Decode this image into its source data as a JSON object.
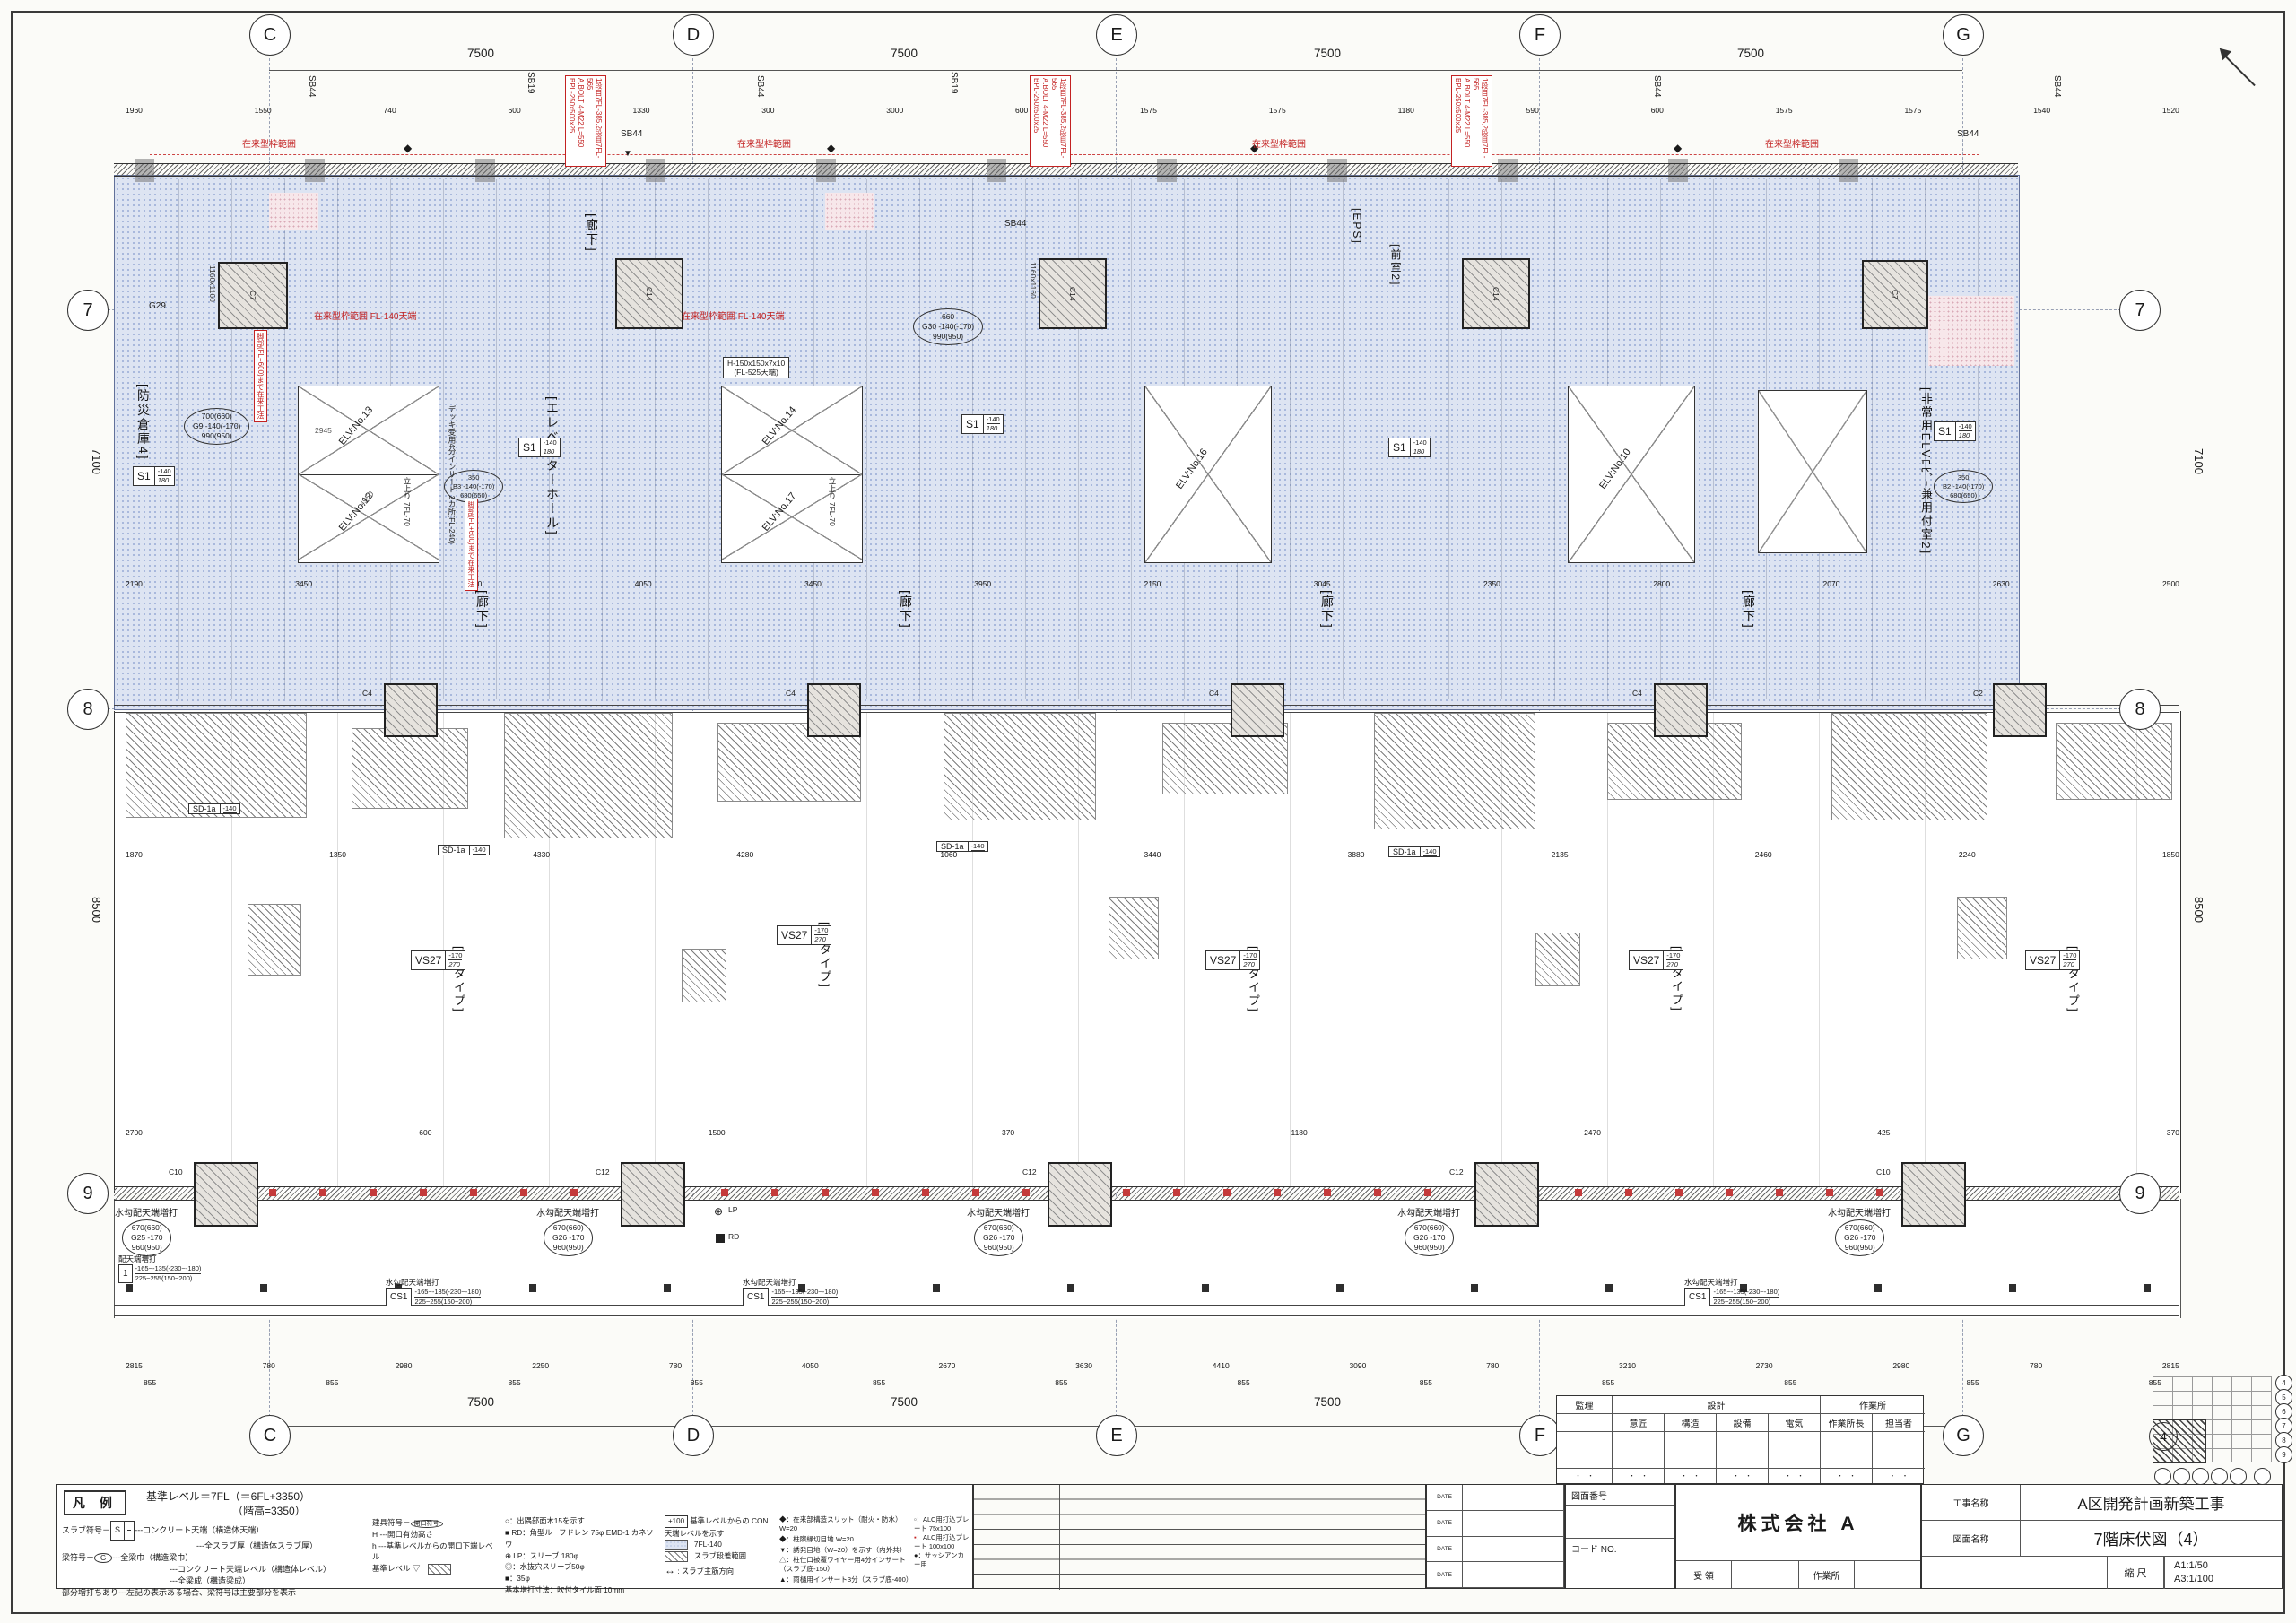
{
  "sheet": {
    "project_label": "工事名称",
    "project_name": "A区開発計画新築工事",
    "drawing_label": "図面名称",
    "drawing_name": "7階床伏図（4）",
    "scale_label": "縮 尺",
    "scale_a1": "A1:1/50",
    "scale_a3": "A3:1/100",
    "company": "株式会社 A",
    "receive_label": "受 領",
    "site_label": "作業所",
    "drawing_no_label": "図面番号",
    "code_no_label": "コード NO.",
    "date_label": "DATE"
  },
  "approval_table": {
    "kanri": "監理",
    "sekkei": "設計",
    "sagyosho": "作業所",
    "sub": [
      "意匠",
      "構造",
      "設備",
      "電気",
      "作業所長",
      "担当者"
    ],
    "dots": "・　・"
  },
  "keyplan": {
    "rows": [
      "4",
      "5",
      "6",
      "7",
      "8",
      "9"
    ],
    "number": "4"
  },
  "legend": {
    "title": "凡 例",
    "base_level": "基準レベル＝7FL（＝6FL+3350）",
    "base_level2": "（階高=3350）",
    "slab_label": "スラブ符号",
    "slab_sym": "S",
    "slab_desc1": "---コンクリート天端（構造体天端）",
    "slab_desc2": "---全スラブ厚（構造体スラブ厚）",
    "beam_label": "梁符号",
    "beam_sym": "G",
    "beam_desc1": "---全梁巾（構造梁巾）",
    "beam_desc2": "---コンクリート天端レベル（構造体レベル）",
    "beam_desc3": "---全梁成（構造梁成）",
    "beam_note": "部分増打ちあり---左記の表示ある場合、梁符号は主要部分を表示",
    "tategu_label": "建具符号",
    "tategu_sym": "開口符号",
    "tategu_h": "H",
    "tategu_h2": "h",
    "tategu_desc1": "開口有効高さ",
    "tategu_desc2": "基準レベルからの開口下端レベル",
    "base_mark": "基準レベル",
    "base_mark_sym": "▽",
    "items_mid": [
      "○：出隅部面木15を示す",
      "■ RD：角型ルーフドレン 75φ EMD-1 カネソウ",
      "⊕ LP：スリーブ 180φ",
      "◎：水抜穴スリーブ50φ",
      "■：35φ",
      "基本増打寸法：吹付タイル面 10mm"
    ],
    "lvl_plus": "+100",
    "lvl_plus_desc": "基準レベルからの CON天端レベルを示す",
    "lvl_dots": "7FL-140",
    "lvl_hatch": "スラブ段差範囲",
    "lvl_arrow": "スラブ主筋方向",
    "arrow_sym": "↔",
    "items_joints": [
      "◆：在来部構造スリット（耐火・防水） W=20",
      "◆：柱際縁切目地 W=20",
      "▼：誘発目地（W=20）を示す（内外共）",
      "△：柱仕口被覆ワイヤー用4分インサート（スラブ底-150）",
      "▲：雨樋用インサート3分（スラブ底-400）"
    ],
    "alc1": "▫：ALC用打込プレート 75x100",
    "alc2_sym": "▪",
    "alc2_text": "：ALC用打込プレート 100x100",
    "alc3": "●：サッシアンカー用"
  },
  "grid": {
    "cols": [
      "C",
      "D",
      "E",
      "F",
      "G"
    ],
    "rows": [
      "7",
      "8",
      "9"
    ],
    "bay": "7500",
    "v_78": "7100",
    "v_89": "8500"
  },
  "plan": {
    "rooms": {
      "bosai": "[防災倉庫4]",
      "elvhall": "[エレベーターホール]",
      "rouka": "[廊下]",
      "zenshitsu": "[前室2]",
      "eps": "[EPS]",
      "hijo": "[非常用ELVﾛﾋﾞｰ兼用付室2]"
    },
    "types": [
      "[14タイプ]",
      "[13タイプ]",
      "[12タイプ]",
      "[11タイプ]",
      "[10タイプ]"
    ],
    "elv": [
      "ELV:No.13",
      "ELV:No.12",
      "ELV:No.14",
      "ELV:No.17",
      "ELV:No.16",
      "ELV:No.10"
    ],
    "red": {
      "zairai": "在来型枠範囲",
      "zairai_fl": "在来型枠範囲 FL-140天端",
      "bpl1": "BPL-250x500x25",
      "bpl2": "A.BOLT 4-M22 L=550",
      "bpl3": "1段目7FL-385,2段目7FL-565",
      "kyakubu": "脚部(FL+600)まで在来工法",
      "deck": "デッキ受用4分インサート 2カ所(FL-240)"
    },
    "tags": {
      "s1": "S1",
      "s1_top": "-140",
      "s1_thk": "180",
      "sd1a": "SD-1a",
      "sd1a_top": "-140",
      "vs27": "VS27",
      "vs27_top": "-170",
      "vs27_thk": "270",
      "cs1": "CS1",
      "cs1_top": "-165~-135(-230~-180)",
      "cs1_thk": "225~255(150~200)",
      "one": "1",
      "c7": "C7",
      "c14": "C14",
      "c4": "C4",
      "c2": "C2",
      "c10": "C10",
      "c12": "C12",
      "col_size": "1160x1160",
      "g29": "G29",
      "g9": [
        "700(660)",
        "G9 -140(-170)",
        "990(950)"
      ],
      "g30": [
        "660",
        "G30 -140(-170)",
        "990(950)"
      ],
      "g25": [
        "670(660)",
        "G25  -170",
        "960(950)"
      ],
      "g26": [
        "670(660)",
        "G26  -170",
        "960(950)"
      ],
      "b3": [
        "350",
        "B3 -140(-170)",
        "680(650)"
      ],
      "b2": [
        "350",
        "B2 -140(-170)",
        "680(650)"
      ]
    },
    "notes": {
      "sb44": "SB44",
      "sb19": "SB19",
      "h_col1": "H-150x150x7x10",
      "h_col2": "(FL-525天端)",
      "tachiagari": "立上り 7FL-70",
      "mizukobai": "水勾配天端増打",
      "haiten": "配天端増打",
      "rd": "RD",
      "lp": "LP",
      "dim2945": "2945",
      "dim4950": "4950",
      "dim1257": "1257",
      "dim2908": "2908",
      "dim3675": "3675",
      "dim3335": "3335",
      "dim2370": "2370"
    },
    "dims": {
      "top_sub": [
        "1960",
        "1550",
        "740",
        "600",
        "1330",
        "300",
        "3000",
        "600",
        "1575",
        "1575",
        "1180",
        "590",
        "600",
        "1575",
        "1575",
        "1540",
        "1520"
      ],
      "mid": [
        "2190",
        "3450",
        "5100",
        "4050",
        "3450",
        "3950",
        "2150",
        "3045",
        "2350",
        "2800",
        "2070",
        "2630",
        "2500"
      ],
      "lower": [
        "1870",
        "1350",
        "4330",
        "4280",
        "1060",
        "3440",
        "3880",
        "2135",
        "2460",
        "2240",
        "1850"
      ],
      "above9": [
        "2700",
        "600",
        "1500",
        "370",
        "1180",
        "2470",
        "425",
        "370"
      ],
      "bottom1": [
        "2815",
        "780",
        "2980",
        "2250",
        "780",
        "4050",
        "2670",
        "3630",
        "4410",
        "3090",
        "780",
        "3210",
        "2730",
        "2980",
        "780",
        "2815"
      ],
      "bottom2": [
        "855",
        "855",
        "855",
        "855",
        "855",
        "855",
        "855",
        "855",
        "855",
        "855",
        "855",
        "855"
      ]
    }
  }
}
